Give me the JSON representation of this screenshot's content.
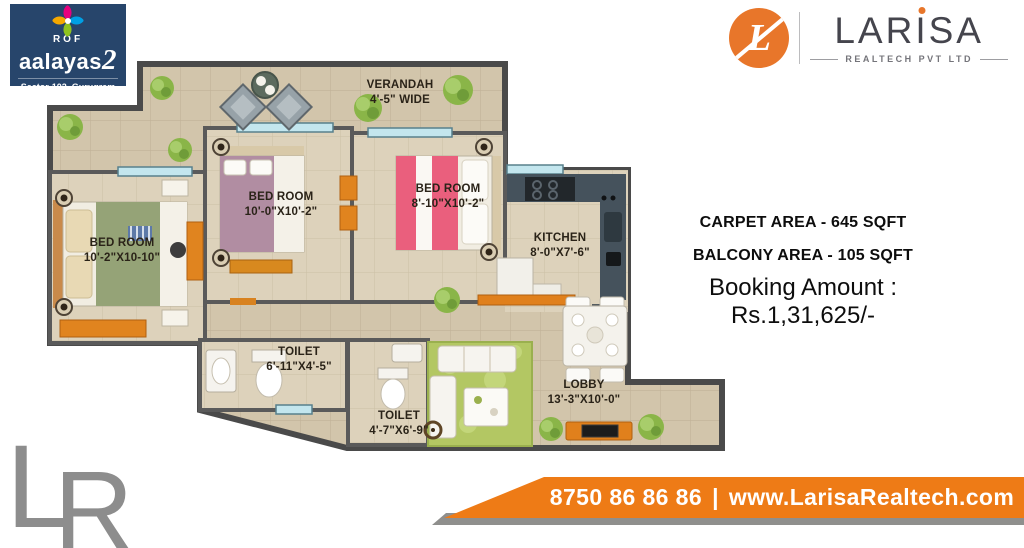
{
  "rof_logo": {
    "name": "ROF",
    "brand": "aalayas",
    "brand_suffix": "2",
    "location": "Sector-102, Gurugram"
  },
  "larisa_logo": {
    "monogram": "L",
    "brand_part1": "LAR",
    "brand_i": "I",
    "brand_part2": "SA",
    "tagline": "REALTECH PVT LTD"
  },
  "floorplan": {
    "verandah": {
      "name": "VERANDAH",
      "dim": "4'-5\" WIDE"
    },
    "bedroom_left": {
      "name": "BED ROOM",
      "dim": "10'-2\"X10-10\""
    },
    "bedroom_mid": {
      "name": "BED ROOM",
      "dim": "10'-0\"X10'-2\""
    },
    "bedroom_right": {
      "name": "BED ROOM",
      "dim": "8'-10\"X10'-2\""
    },
    "kitchen": {
      "name": "KITCHEN",
      "dim": "8'-0\"X7'-6\""
    },
    "toilet_left": {
      "name": "TOILET",
      "dim": "6'-11\"X4'-5\""
    },
    "toilet_right": {
      "name": "TOILET",
      "dim": "4'-7\"X6'-9\""
    },
    "lobby": {
      "name": "LOBBY",
      "dim": "13'-3\"X10'-0\""
    }
  },
  "details": {
    "carpet_area": "CARPET AREA - 645 SQFT",
    "balcony_area": "BALCONY AREA - 105 SQFT",
    "booking": "Booking Amount : Rs.1,31,625/-"
  },
  "footer": {
    "phone": "8750 86 86 86",
    "separator": "|",
    "website": "www.LarisaRealtech.com"
  },
  "watermark": {
    "l": "L",
    "r": "R"
  },
  "colors": {
    "orange": "#ee7b16",
    "navy": "#27456b"
  }
}
